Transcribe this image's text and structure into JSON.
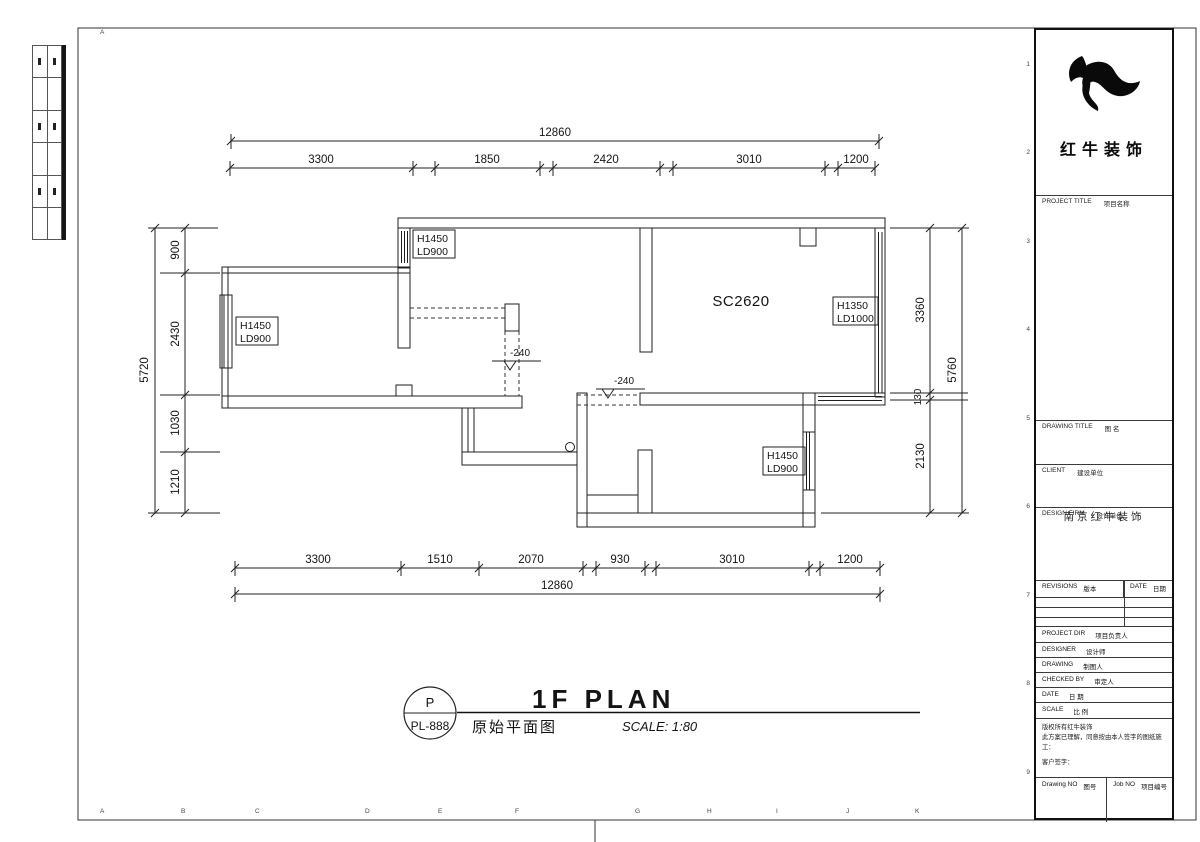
{
  "sheet": {
    "frame_letters": [
      "A",
      "B",
      "C",
      "D",
      "E",
      "F",
      "G",
      "H",
      "I",
      "J",
      "K"
    ],
    "frame_numbers": [
      "1",
      "2",
      "3",
      "4",
      "5",
      "6",
      "7",
      "8",
      "9"
    ]
  },
  "dims": {
    "top_overall": "12860",
    "top_segments": [
      "3300",
      "1850",
      "2420",
      "3010",
      "1200"
    ],
    "bottom_segments": [
      "3300",
      "1510",
      "2070",
      "930",
      "3010",
      "1200"
    ],
    "bottom_overall": "12860",
    "left_overall": "5720",
    "left_segments": [
      "900",
      "2430",
      "1030",
      "1210"
    ],
    "right_segments": [
      "3360",
      "130",
      "2130"
    ],
    "right_overall": "5760"
  },
  "plan": {
    "room_label": "SC2620",
    "window_top": {
      "l1": "H1450",
      "l2": "LD900"
    },
    "window_left": {
      "l1": "H1450",
      "l2": "LD900"
    },
    "window_right_upper": {
      "l1": "H1350",
      "l2": "LD1000"
    },
    "window_right_lower": {
      "l1": "H1450",
      "l2": "LD900"
    },
    "level_marker_1": "-240",
    "level_marker_2": "-240"
  },
  "title": {
    "code_letter": "P",
    "sheet_no": "PL-888",
    "name_en": "1F PLAN",
    "name_cn": "原始平面图",
    "scale_note": "SCALE: 1:80"
  },
  "titleblock": {
    "brand": "红牛装饰",
    "project_title_en": "PROJECT TITLE",
    "project_title_cn": "项目名称",
    "drawing_title_en": "DRAWING TITLE",
    "drawing_title_cn": "图 名",
    "client_en": "CLIENT",
    "client_cn": "建设单位",
    "design_firm_en": "DESIGN FIRM",
    "design_firm_cn": "设计单位",
    "design_firm_value": "南京红牛装饰",
    "revisions_en": "REVISIONS",
    "revisions_cn": "版本",
    "date_col_en": "DATE",
    "date_col_cn": "日期",
    "project_dir_en": "PROJECT DIR",
    "project_dir_cn": "项目负责人",
    "designer_en": "DESIGNER",
    "designer_cn": "设计师",
    "drawing_en": "DRAWING",
    "drawing_cn": "制图人",
    "checked_en": "CHECKED BY",
    "checked_cn": "审定人",
    "date_en": "DATE",
    "date_cn": "日 期",
    "scale_en": "SCALE",
    "scale_cn": "比 例",
    "copyright_1": "版权所有红牛装饰",
    "copyright_2": "此方案已理解，同意按由本人签字的图纸施工：",
    "copyright_3": "客户签字：",
    "drawing_no_en": "Drawing NO",
    "drawing_no_cn": "图号",
    "job_no_en": "Job NO",
    "job_no_cn": "项目编号"
  }
}
